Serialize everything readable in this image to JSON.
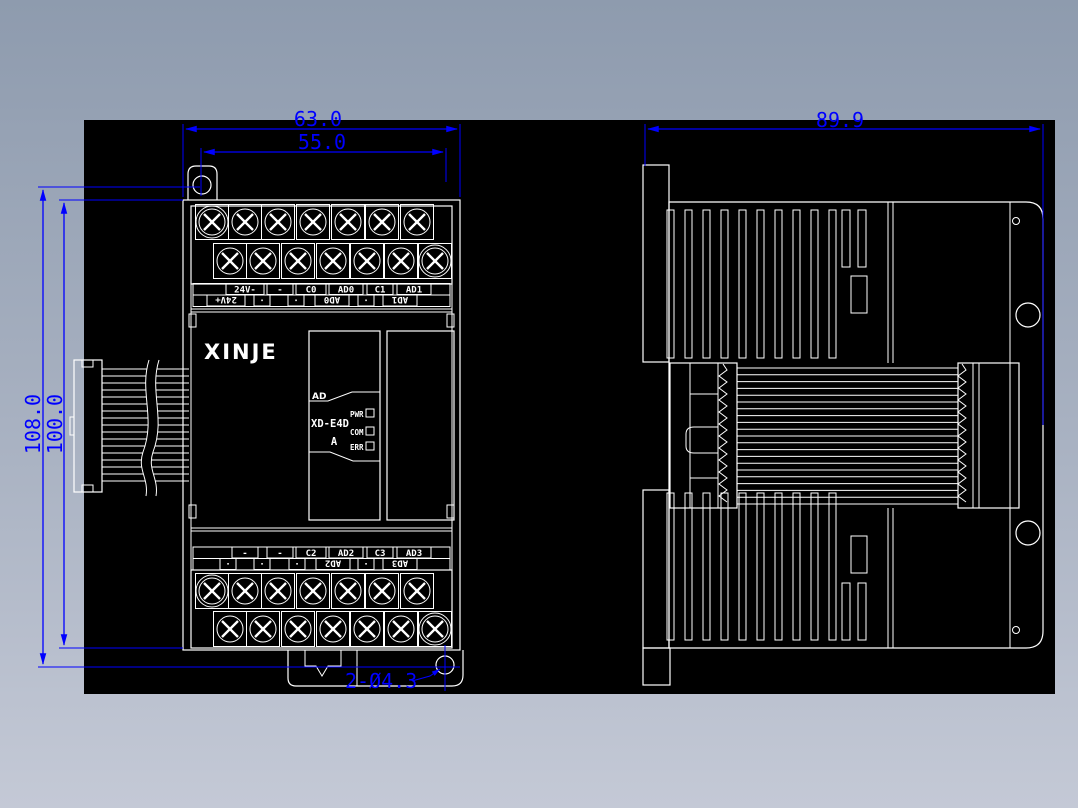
{
  "colors": {
    "dimension": "#0000ff",
    "line": "#ffffff",
    "canvas": "#000000"
  },
  "dimensions": {
    "front_total_width": "63.0",
    "front_hole_spacing": "55.0",
    "side_depth": "89.9",
    "total_height": "108.0",
    "body_height": "100.0",
    "mounting_holes": "2-Ø4.3"
  },
  "device": {
    "brand": "XINJE",
    "channel_tab": "AD",
    "model": "XD-E4D",
    "model_suffix": "A",
    "leds": [
      "PWR",
      "COM",
      "ERR"
    ]
  },
  "terminals": {
    "top_row1": [
      "24V-",
      "-",
      "C0",
      "AD0",
      "C1",
      "AD1"
    ],
    "top_row2": [
      "24V+",
      "·",
      "·",
      "AD0",
      "·",
      "AD1"
    ],
    "bottom_row1": [
      "-",
      "-",
      "C2",
      "AD2",
      "C3",
      "AD3"
    ],
    "bottom_row2": [
      "·",
      "·",
      "·",
      "AD2",
      "·",
      "AD3"
    ]
  }
}
